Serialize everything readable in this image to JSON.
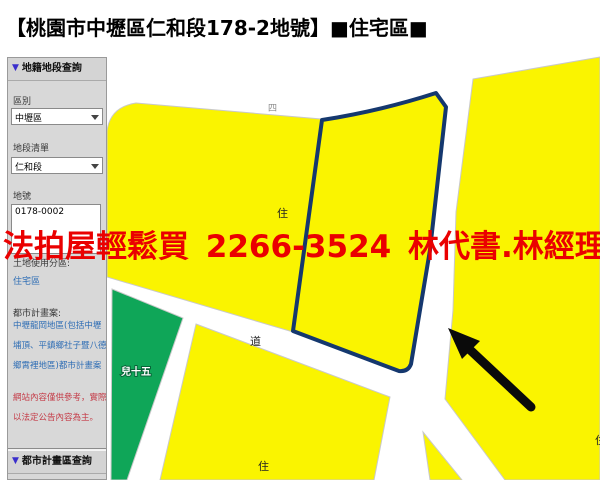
{
  "title": "【桃園市中壢區仁和段178-2地號】■住宅區■",
  "banner": {
    "text": "法拍屋輕鬆買  2266-3524  林代書.林經理",
    "color": "#ea0000"
  },
  "icons": {
    "section_triangle": "▼"
  },
  "sidebar": {
    "cadastral_header": "地籍地段查詢",
    "plan_zone_header": "都市計畫區查詢",
    "district_label": "區別",
    "district_value": "中壢區",
    "section_list_label": "地段清單",
    "section_list_value": "仁和段",
    "parcel_label": "地號",
    "parcel_value": "0178-0002",
    "zoning_label": "土地使用分區:",
    "zoning_value": "住宅區",
    "plan_label": "都市計畫案:",
    "plan_value": "中壢龍岡地區(包括中壢埔頂、平鎮鄉社子暨八德鄉霄裡地區)都市計畫案",
    "disclaimer": "網站內容僅供參考，實際以法定公告內容為主。"
  },
  "map": {
    "labels": {
      "zone_center": "住",
      "road": "道",
      "zone_bottom": "住",
      "zone_right_clipped": "住",
      "green_zone": "兒十五",
      "top_fragment": "四"
    },
    "colors": {
      "residential": "#faf400",
      "park_green": "#0fa658",
      "parcel_outline": "#15386e",
      "block_border": "#c9c9c9",
      "label_dark": "#222222",
      "arrow_black": "#0a0a0a",
      "green_label_stroke": "#066337",
      "green_label_fill": "#ffffff"
    }
  }
}
